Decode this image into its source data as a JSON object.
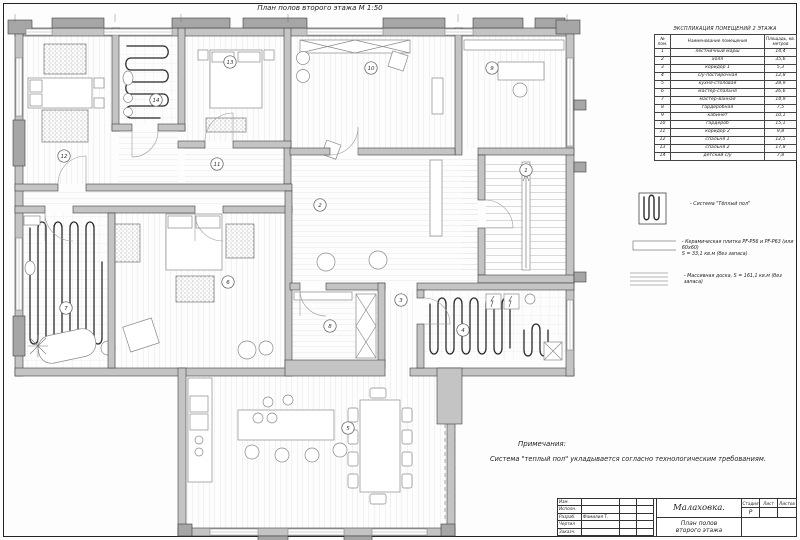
{
  "sheet": {
    "title": "План полов второго этажа М 1:50"
  },
  "explication": {
    "title": "ЭКСПЛИКАЦИЯ ПОМЕЩЕНИЙ 2 ЭТАЖА",
    "columns": [
      "№ пом.",
      "Наименование помещения",
      "Площадь, кв. метров"
    ],
    "rows": [
      [
        "1",
        "лестничный марш",
        "14,4"
      ],
      [
        "2",
        "холл",
        "35,6"
      ],
      [
        "3",
        "коридор 1",
        "5,3"
      ],
      [
        "4",
        "с/у-постирочная",
        "12,8"
      ],
      [
        "5",
        "кухня-столовая",
        "28,9"
      ],
      [
        "6",
        "мастер-спальня",
        "26,6"
      ],
      [
        "7",
        "мастер-ванная",
        "14,9"
      ],
      [
        "8",
        "гардеробная",
        "7,5"
      ],
      [
        "9",
        "кабинет",
        "10,1"
      ],
      [
        "10",
        "гардероб",
        "15,1"
      ],
      [
        "11",
        "коридор 2",
        "9,8"
      ],
      [
        "12",
        "спальня 1",
        "12,5"
      ],
      [
        "13",
        "спальня 2",
        "17,8"
      ],
      [
        "14",
        "детский с/у",
        "7,8"
      ]
    ]
  },
  "legend": {
    "items": [
      {
        "symbol": "heated-floor-coil",
        "label": "- Система \"Тёплый пол\""
      },
      {
        "symbol": "ceramic-tile",
        "label": "- Керамическая плитка PF-P56 и PF-P63 (или 60х60)",
        "label2": "S = 33,1 кв.м (без запаса)"
      },
      {
        "symbol": "solid-board",
        "label": "- Массивная доска, S = 161,1 кв.м (без запаса)"
      }
    ]
  },
  "notes": {
    "heading": "Примечания:",
    "text": "Система \"теплый пол\" укладывается согласно технологическим требованиям."
  },
  "title_block": {
    "project": "Малаховка.",
    "drawing_line1": "План полов",
    "drawing_line2": "второго этажа",
    "rows": [
      "Изм.",
      "Исполн.",
      "Разраб.",
      "Чертил",
      "Заказч."
    ],
    "designer": "Фамилия Т.",
    "stage_label": "Стадия",
    "sheet_label": "Лист",
    "sheets_label": "Листов",
    "stage_value": "Р"
  },
  "plan": {
    "room_labels": [
      {
        "num": "1",
        "x": 526,
        "y": 170
      },
      {
        "num": "2",
        "x": 320,
        "y": 205
      },
      {
        "num": "3",
        "x": 401,
        "y": 300
      },
      {
        "num": "4",
        "x": 463,
        "y": 330
      },
      {
        "num": "5",
        "x": 348,
        "y": 428
      },
      {
        "num": "6",
        "x": 228,
        "y": 282
      },
      {
        "num": "7",
        "x": 66,
        "y": 308
      },
      {
        "num": "8",
        "x": 330,
        "y": 326
      },
      {
        "num": "9",
        "x": 492,
        "y": 68
      },
      {
        "num": "10",
        "x": 371,
        "y": 68
      },
      {
        "num": "11",
        "x": 217,
        "y": 164
      },
      {
        "num": "12",
        "x": 64,
        "y": 156
      },
      {
        "num": "13",
        "x": 230,
        "y": 62
      },
      {
        "num": "14",
        "x": 156,
        "y": 100
      }
    ],
    "colors": {
      "wall": "#c4c4c4",
      "pier": "#a6a6a6",
      "line": "#3f3f3f",
      "coil": "#2a2a2a"
    }
  }
}
